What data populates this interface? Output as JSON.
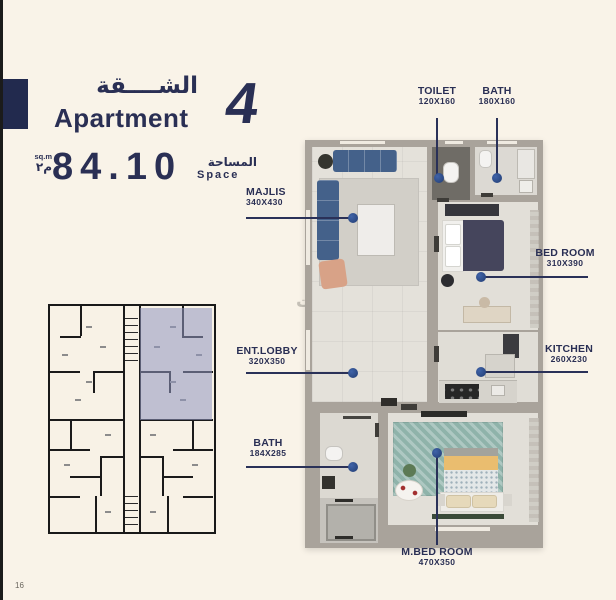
{
  "header": {
    "title_ar": "الشــــقة",
    "title_en": "Apartment",
    "unit_number": "4",
    "area_value": "84.10",
    "area_unit_en": "sq.m",
    "area_unit_ar": "م٢",
    "area_label_ar": "المساحة",
    "area_label_en": "Space"
  },
  "floorplan": {
    "rooms": [
      {
        "name": "TOILET",
        "dims": "120X160"
      },
      {
        "name": "BATH",
        "dims": "180X160"
      },
      {
        "name": "MAJLIS",
        "dims": "340X430"
      },
      {
        "name": "BED ROOM",
        "dims": "310X390"
      },
      {
        "name": "KITCHEN",
        "dims": "260X230"
      },
      {
        "name": "ENT.LOBBY",
        "dims": "320X350"
      },
      {
        "name": "BATH",
        "dims": "184X285"
      },
      {
        "name": "M.BED ROOM",
        "dims": "470X350"
      }
    ]
  },
  "keyplan": {
    "highlighted_unit": "4"
  },
  "watermark": {
    "text": "بيوت"
  },
  "page": {
    "number": "16"
  },
  "colors": {
    "navy": "#2a2f54",
    "cream": "#f9f3e8",
    "leader_dot": "#2b4b8c",
    "keyplan_highlight": "#9096c0"
  }
}
